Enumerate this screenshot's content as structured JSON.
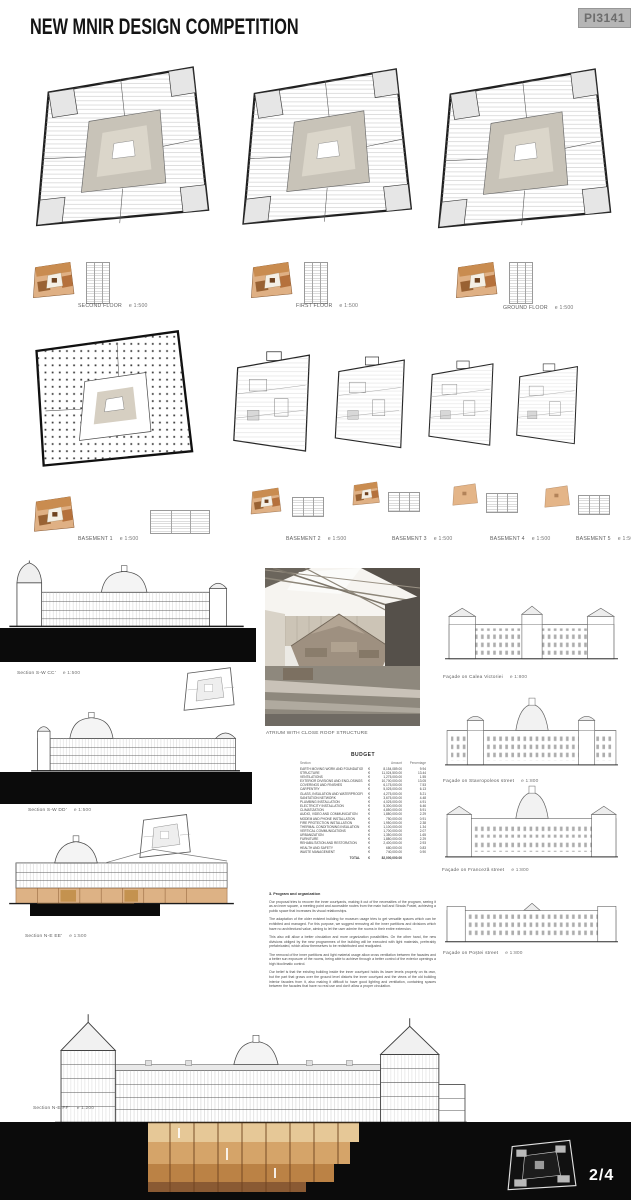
{
  "header": {
    "title": "NEW MNIR DESIGN COMPETITION",
    "code": "PI3141"
  },
  "floor_plans": [
    {
      "name": "SECOND FLOOR",
      "scale": "e 1:500"
    },
    {
      "name": "FIRST FLOOR",
      "scale": "e 1:500"
    },
    {
      "name": "GROUND FLOOR",
      "scale": "e 1:500"
    }
  ],
  "basement_plans": [
    {
      "name": "BASEMENT 1",
      "scale": "e 1:500"
    },
    {
      "name": "BASEMENT 2",
      "scale": "e 1:500"
    },
    {
      "name": "BASEMENT 3",
      "scale": "e 1:500"
    },
    {
      "name": "BASEMENT 4",
      "scale": "e 1:500"
    },
    {
      "name": "BASEMENT 5",
      "scale": "e 1:500"
    }
  ],
  "sections": [
    {
      "name": "Section S-W  CC'",
      "scale": "e 1:500"
    },
    {
      "name": "Section S-W  DD'",
      "scale": "e 1:500"
    },
    {
      "name": "Section N-E  EE'",
      "scale": "e 1:500"
    }
  ],
  "render": {
    "caption": "ATRIUM WITH CLOSE ROOF STRUCTURE"
  },
  "budget": {
    "title": "BUDGET",
    "columns": [
      "Section",
      "Amount",
      "Percentage"
    ],
    "currency": "€",
    "rows": [
      {
        "item": "EARTH MOVING WORK AND FOUNDATIONS",
        "amount": "8,154,089.00",
        "pct": "9.94"
      },
      {
        "item": "STRUCTURE",
        "amount": "11,024,500.00",
        "pct": "13.44"
      },
      {
        "item": "VENTILATIONS",
        "amount": "1,275,000.00",
        "pct": "1.55"
      },
      {
        "item": "EXTERIOR DIVISIONS AND ENCLOSINGS",
        "amount": "10,700,000.00",
        "pct": "13.05"
      },
      {
        "item": "COVERINGS AND FINISHES",
        "amount": "6,175,000.00",
        "pct": "7.53"
      },
      {
        "item": "CARPENTRY",
        "amount": "5,025,000.00",
        "pct": "6.13"
      },
      {
        "item": "GLASS, INSULATION AND WATERPROOFING",
        "amount": "4,275,000.00",
        "pct": "5.21"
      },
      {
        "item": "SANITATION NETWORK",
        "amount": "3,675,000.00",
        "pct": "4.48"
      },
      {
        "item": "PLUMBING INSTALLATION",
        "amount": "4,025,000.00",
        "pct": "4.91"
      },
      {
        "item": "ELECTRICITY INSTALLATION",
        "amount": "5,300,000.00",
        "pct": "6.46"
      },
      {
        "item": "CLIMATIZATION",
        "amount": "4,850,000.00",
        "pct": "5.91"
      },
      {
        "item": "AUDIO, VIDEO AND COMMUNICATION",
        "amount": "1,880,000.00",
        "pct": "2.29"
      },
      {
        "item": "MODEM AND PHONE INSTALLATION",
        "amount": "750,000.00",
        "pct": "0.91"
      },
      {
        "item": "FIRE PROTECTION INSTALLATION",
        "amount": "1,950,000.00",
        "pct": "2.38"
      },
      {
        "item": "THERMAL CONDITIONING INSULATION",
        "amount": "1,100,000.00",
        "pct": "1.34"
      },
      {
        "item": "VERTICAL COMMUNICATIONS",
        "amount": "1,700,000.00",
        "pct": "2.07"
      },
      {
        "item": "URBANIZATION",
        "amount": "1,350,000.00",
        "pct": "1.65"
      },
      {
        "item": "FURNITURE",
        "amount": "1,880,000.00",
        "pct": "2.29"
      },
      {
        "item": "REHABILITATION AND RESTORATION",
        "amount": "2,400,000.00",
        "pct": "2.93"
      },
      {
        "item": "HEALTH AND SAFETY",
        "amount": "680,000.00",
        "pct": "0.83"
      },
      {
        "item": "WASTE MANAGEMENT",
        "amount": "740,000.00",
        "pct": "0.90"
      }
    ],
    "total_label": "TOTAL",
    "total_amount": "82,000,000.00"
  },
  "program_text": {
    "heading": "3. Program and organization",
    "paragraphs": [
      "Our proposal tries to recover the inner courtyards, making it out of the necessities of the program, seeing it as an inner square, a meeting point and accessible routes from the main hall and Strada Postei, achieving a public space that increases its visual relationships.",
      "The adaptation of the older existent building for museum usage tries to get versatile spaces which can be exhibited and managed. For this purpose, we suggest removing all the inner partitions and divisions which have no architectural value, aiming to let the user admire the rooms in their entire extension.",
      "This also will allow a better circulation and more organization possibilities. On the other hand, the new divisions obliged by the new programmes of the building will be executed with light materials, preferably prefabricated, which allow themselves to be redistributed and readjusted.",
      "The removal of the inner partitions and light material usage allow cross ventilation between the facades and a better sun exposure of the rooms, being able to achieve through a better control of the exterior openings a high bioclimatic control.",
      "Our belief is that the existing building inside the inner courtyard holds its lower levels properly on its own, but the part that grows over the ground level distorts the inner courtyard and the views of the old building interior facades from it, also making it difficult to have good lighting and ventilation, containing spaces between the facades that have no real use and don't allow a proper circulation."
    ]
  },
  "facades": [
    {
      "name": "Façade on Calea Victoriei",
      "scale": "e 1:800"
    },
    {
      "name": "Façade on Stavropoleos street",
      "scale": "e 1:800"
    },
    {
      "name": "Façade on Franceză street",
      "scale": "e 1:800"
    },
    {
      "name": "Façade on Poștei street",
      "scale": "e 1:800"
    }
  ],
  "bottom_section": {
    "name": "Section N-E  FF'",
    "scale": "e 1:200"
  },
  "page_number": "2/4",
  "colors": {
    "accent_tan": "#d9a36b",
    "accent_brown": "#8a5a33",
    "ink": "#1c1c1c"
  }
}
